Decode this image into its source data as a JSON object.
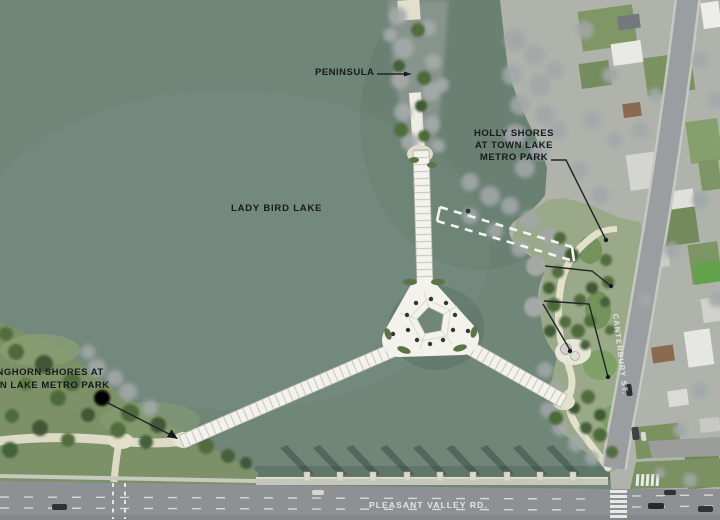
{
  "labels": {
    "peninsula": "PENINSULA",
    "holly_shores": [
      "HOLLY SHORES",
      "AT TOWN LAKE",
      "METRO PARK"
    ],
    "lake": "LADY BIRD LAKE",
    "longhorn_shores": [
      "LONGHORN SHORES AT",
      "TOWN LAKE METRO PARK"
    ],
    "pleasant_valley_rd": "PLEASANT VALLEY RD.",
    "canterbury_st": "CANTERBURY ST."
  },
  "colors": {
    "water": "#6F8679",
    "park_grass": "#7D9168",
    "road_gray": "#8E9294",
    "bridge_deck": "#F3F2ED",
    "dashed_alignment": "#F4F5F1",
    "label_dark": "#16191D",
    "label_light": "#E9EBE7"
  }
}
